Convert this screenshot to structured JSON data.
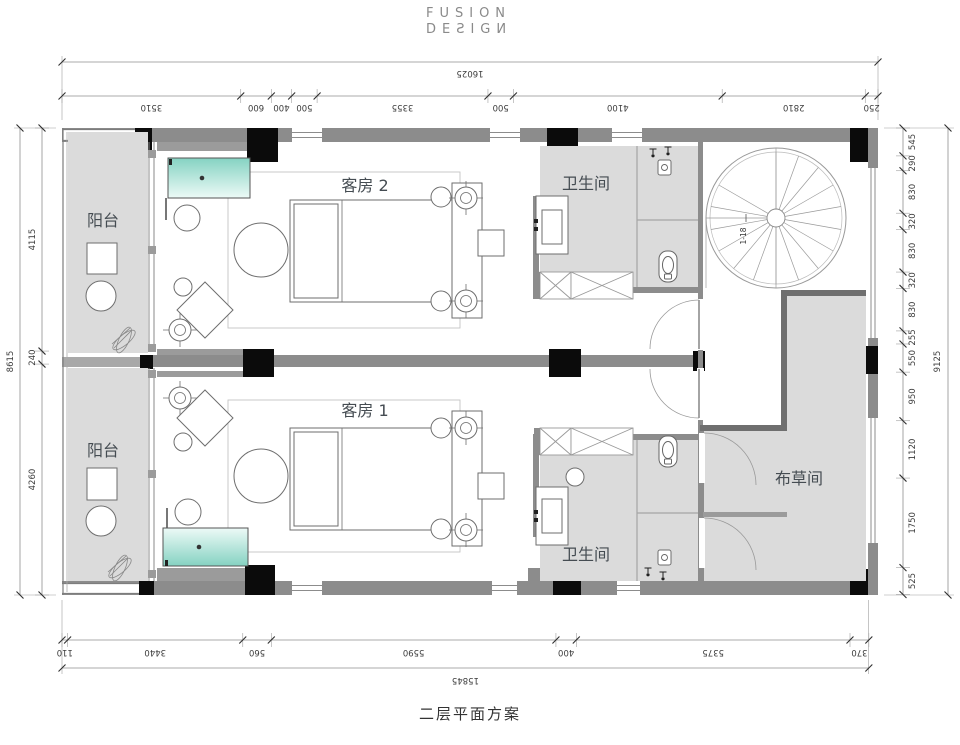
{
  "logo": {
    "line1": "FUSION",
    "line2": "DEƧIGИ"
  },
  "caption": "二层平面方案",
  "rooms": {
    "balcony_top": "阳台",
    "balcony_bottom": "阳台",
    "guest2": "客房 2",
    "guest1": "客房 1",
    "bath_top": "卫生间",
    "bath_bottom": "卫生间",
    "linen": "布草间"
  },
  "stair": {
    "label": "1-18"
  },
  "dimensions": {
    "top": {
      "total": "16025",
      "segments": [
        "3510",
        "600",
        "400",
        "500",
        "3355",
        "500",
        "4100",
        "2810",
        "250"
      ]
    },
    "bottom": {
      "total": "15845",
      "segments": [
        "110",
        "3440",
        "560",
        "5590",
        "400",
        "5375",
        "370"
      ]
    },
    "left": {
      "total": "8615",
      "segments": [
        "4115",
        "240",
        "4260"
      ]
    },
    "right": {
      "total": "9125",
      "segments": [
        "545",
        "290",
        "830",
        "320",
        "830",
        "320",
        "830",
        "255",
        "550",
        "950",
        "1120",
        "1750",
        "525"
      ]
    }
  },
  "colors": {
    "wall": "#8c8c8c",
    "column": "#0b0b0b",
    "floor": "#dbdbdb",
    "tub_dark": "#85d2c2",
    "tub_light": "#edfaf7",
    "dim_text": "#3c3c3c"
  }
}
